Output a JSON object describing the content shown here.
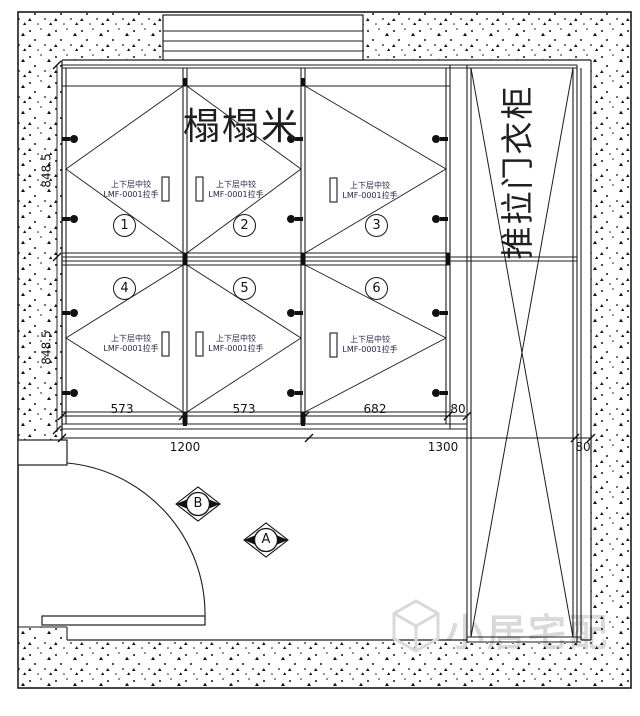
{
  "drawing": {
    "title": "榻榻米",
    "wardrobe_label": "推拉门衣柜",
    "watermark": "小居宅配"
  },
  "cells": [
    {
      "number": "1",
      "hinge_label": "上下层中铰",
      "handle_label": "LMF-0001拉手"
    },
    {
      "number": "2",
      "hinge_label": "上下层中铰",
      "handle_label": "LMF-0001拉手"
    },
    {
      "number": "3",
      "hinge_label": "上下层中铰",
      "handle_label": "LMF-0001拉手"
    },
    {
      "number": "4",
      "hinge_label": "上下层中铰",
      "handle_label": "LMF-0001拉手"
    },
    {
      "number": "5",
      "hinge_label": "上下层中铰",
      "handle_label": "LMF-0001拉手"
    },
    {
      "number": "6",
      "hinge_label": "上下层中铰",
      "handle_label": "LMF-0001拉手"
    }
  ],
  "dimensions": {
    "row_heights": [
      "848.5",
      "848.5"
    ],
    "inner_widths": [
      "573",
      "573",
      "682",
      "80"
    ],
    "overall_widths": [
      "1200",
      "1300",
      "80"
    ]
  },
  "markers": [
    {
      "label": "B"
    },
    {
      "label": "A"
    }
  ],
  "colors": {
    "line": "#1c1c1c",
    "cell_label_text": "#26264a",
    "watermark_gray": "#d9d9d9"
  }
}
